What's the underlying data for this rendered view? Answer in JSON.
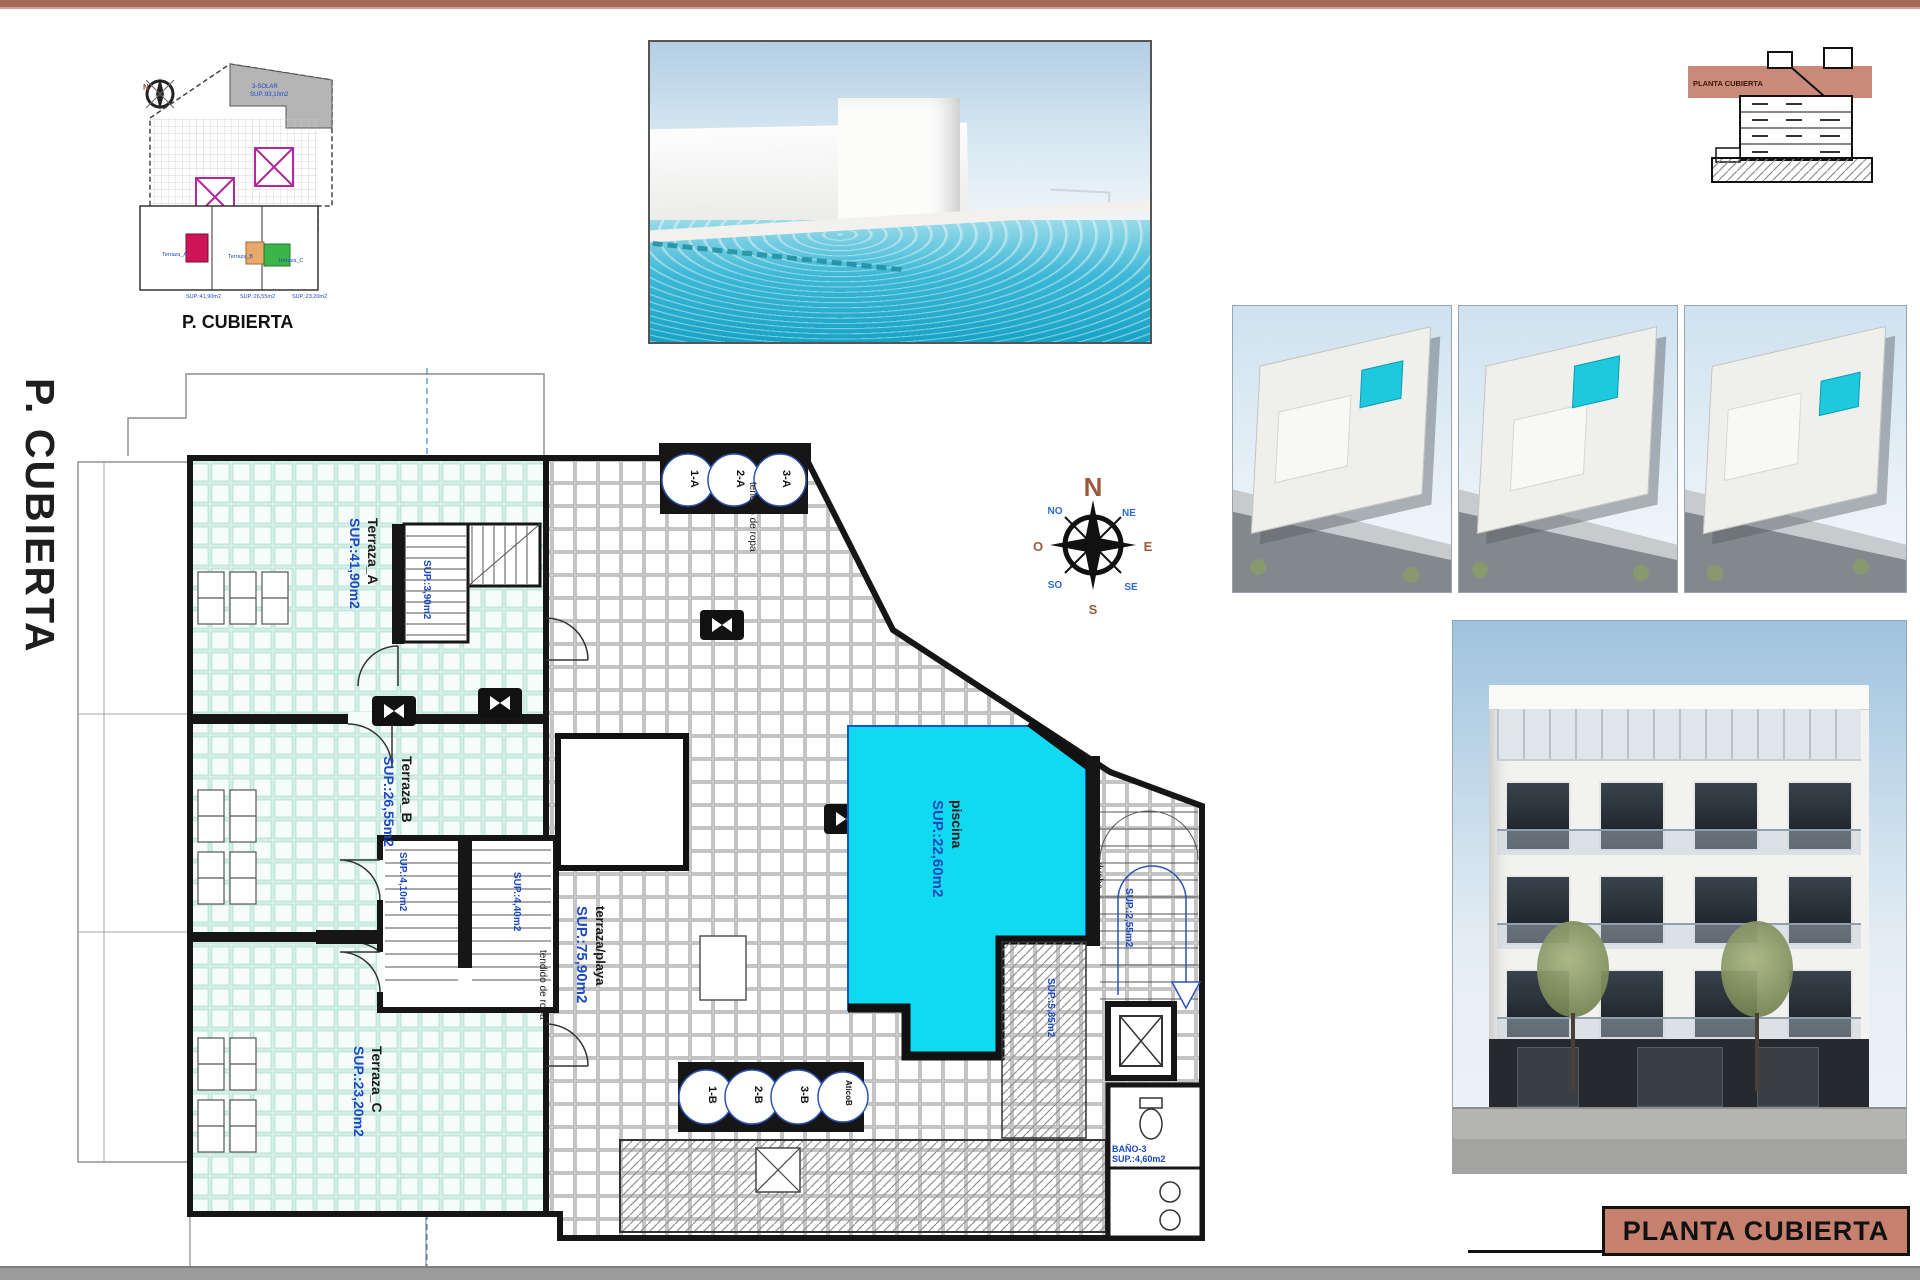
{
  "colors": {
    "accent": "#c5806e",
    "pool": "#10daf0",
    "annotation_blue": "#1b49c4"
  },
  "key_plan": {
    "caption": "P. CUBIERTA",
    "labels": [
      "3-SOLAR",
      "SUP.:93,10m2",
      "Terraza_A",
      "Terraza_B",
      "Terraza_C",
      "SUP.:41,90m2",
      "SUP.:26,55m2",
      "SUP.:23,20m2"
    ]
  },
  "plan": {
    "side_title": "P. CUBIERTA",
    "terrace_a": {
      "name": "Terraza_A",
      "area": "SUP.:41,90m2"
    },
    "terrace_b": {
      "name": "Terraza_B",
      "area": "SUP.:26,55m2"
    },
    "terrace_c": {
      "name": "Terraza_C",
      "area": "SUP.:23,20m2"
    },
    "beach_terrace": {
      "name": "terraza/playa",
      "area": "SUP.:75,90m2"
    },
    "pool": {
      "name": "piscina",
      "area": "SUP.:22,60m2"
    },
    "stair_a_area": "SUP.:3,90m2",
    "stair_b_area": "SUP.:4,10m2",
    "stair_c_area": "SUP.:4,40m2",
    "stair_main_area": "SUP.:2,55m2",
    "solarium_area": "SUP.:5,85m2",
    "bath": {
      "name": "BAÑO-3",
      "area": "SUP.:4,60m2"
    },
    "clothesline": "tendido de ropa",
    "shower": "ducha",
    "skylights_top": [
      "1-A",
      "2-A",
      "3-A"
    ],
    "skylights_bottom": [
      "1-B",
      "2-B",
      "3-B",
      "AticoB"
    ],
    "compass": {
      "n": "N",
      "ne": "NE",
      "e": "E",
      "se": "SE",
      "s": "S",
      "so": "SO",
      "o": "O",
      "no": "NO"
    }
  },
  "section_thumb": {
    "band_label": "PLANTA CUBIERTA"
  },
  "title_block": {
    "label": "PLANTA CUBIERTA"
  }
}
